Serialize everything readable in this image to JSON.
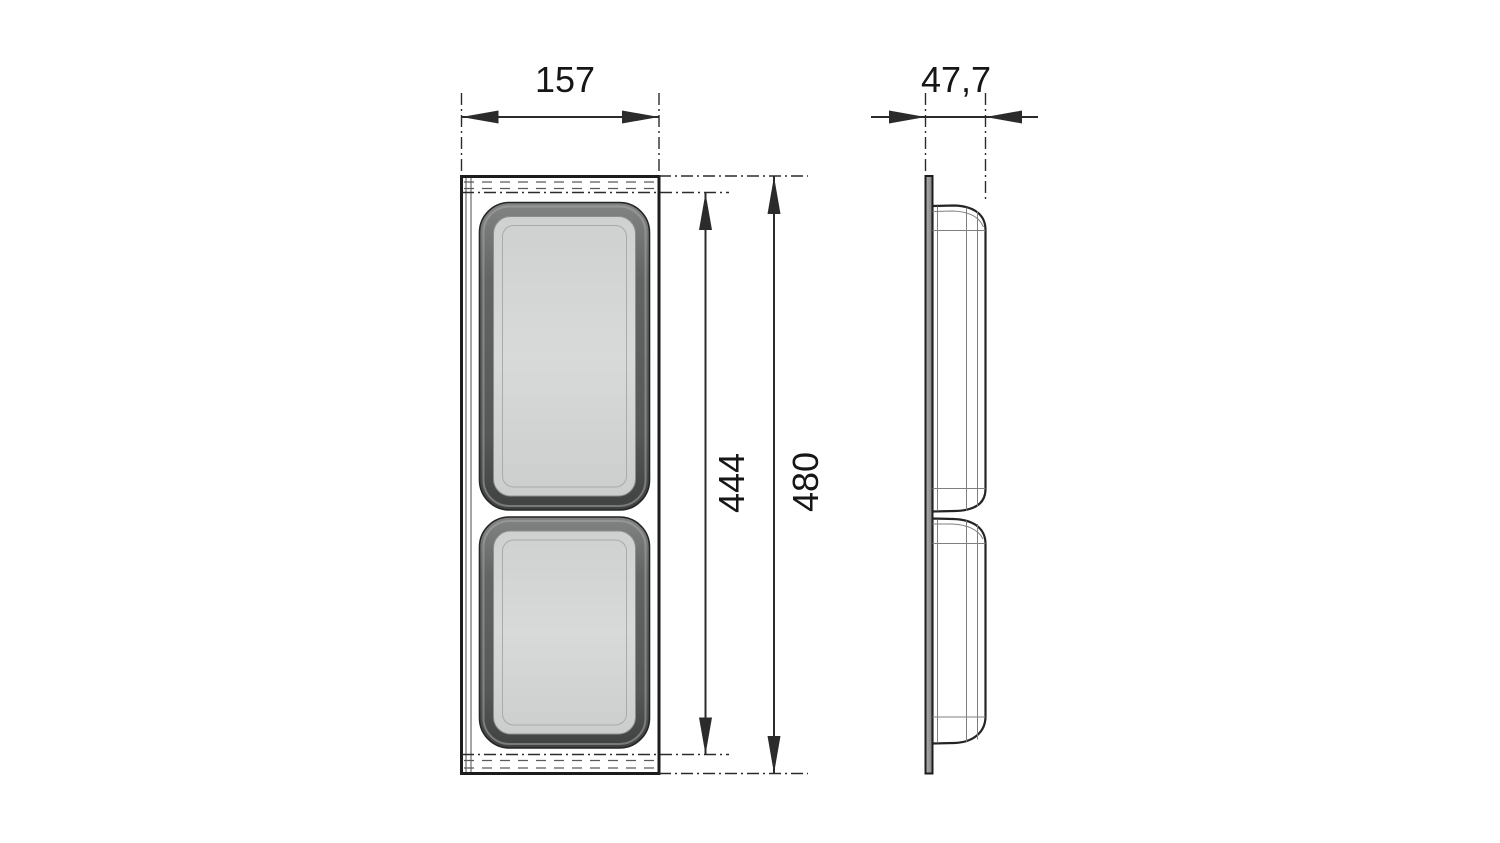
{
  "drawing": {
    "description": "Dimensioned technical drawing of a two-compartment drawer insert tray: front view and side profile view",
    "views": {
      "front": {
        "name": "front view"
      },
      "side": {
        "name": "side profile view"
      }
    },
    "dimensions": {
      "width": {
        "value": "157",
        "orientation": "horizontal",
        "applies_to": "front view overall width"
      },
      "depth": {
        "value": "47,7",
        "orientation": "horizontal",
        "applies_to": "side view overall depth"
      },
      "inner_height": {
        "value": "444",
        "orientation": "vertical",
        "applies_to": "height between top and bottom flanges"
      },
      "overall_height": {
        "value": "480",
        "orientation": "vertical",
        "applies_to": "front view overall height"
      }
    },
    "colors": {
      "background": "#ffffff",
      "outline": "#1c1c1c",
      "dimension_ink": "#2b2b2b",
      "frame_fill": "#e9eaea",
      "recess_band_dark": "#4b4d4d",
      "recess_floor_light": "#d6d7d7",
      "side_plate": "#9a9c9c",
      "side_bulge": "#d3d5d5"
    }
  }
}
